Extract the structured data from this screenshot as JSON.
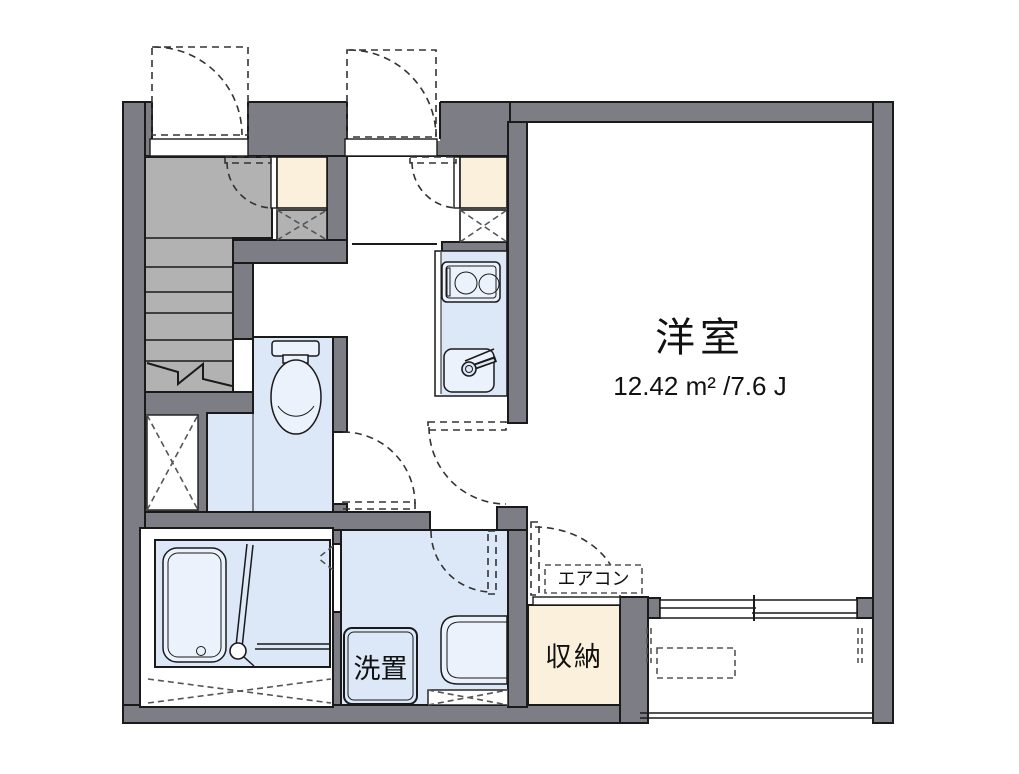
{
  "plan": {
    "unit_labels": {
      "western_room": "洋室",
      "western_room_area": "12.42 m² /7.6 J",
      "storage": "収納",
      "air_conditioner": "エアコン",
      "laundry_space": "洗置"
    },
    "colors": {
      "wall": "#7d7d85",
      "stair": "#b2b2b2",
      "water_room": "#dce8f8",
      "fixture": "#ebf2fb",
      "closet": "#faf0db",
      "line": "#1a1a1a"
    }
  }
}
